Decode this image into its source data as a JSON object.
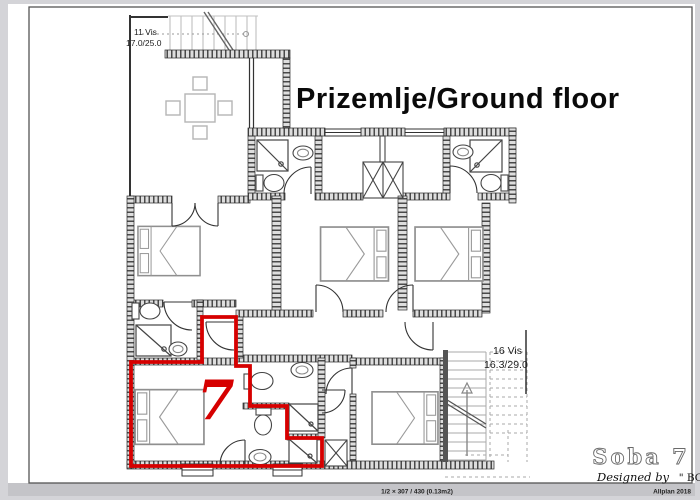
{
  "window": {
    "background": "#d4d4d8",
    "paper": "#ffffff",
    "footer_strip": "#c4c4c8",
    "frame_color": "#555555"
  },
  "plan": {
    "title": "Prizemlje/Ground floor",
    "highlight_color": "#d60000",
    "highlighted_room": {
      "number": "7"
    },
    "labels": {
      "upper_terrace": {
        "line1": "11 Vis",
        "line2": "17.0/25.0"
      },
      "staircase": {
        "line1": "16 Vis",
        "line2": "16.3/29.0"
      }
    }
  },
  "title_block": {
    "room_title": "Soba 7",
    "credit_script": "Designed by",
    "credit_name": "\" BOVA\""
  },
  "footer": {
    "print_info": "1/2 × 307 / 430 (0.13m2)",
    "software": "Allplan 2018"
  }
}
